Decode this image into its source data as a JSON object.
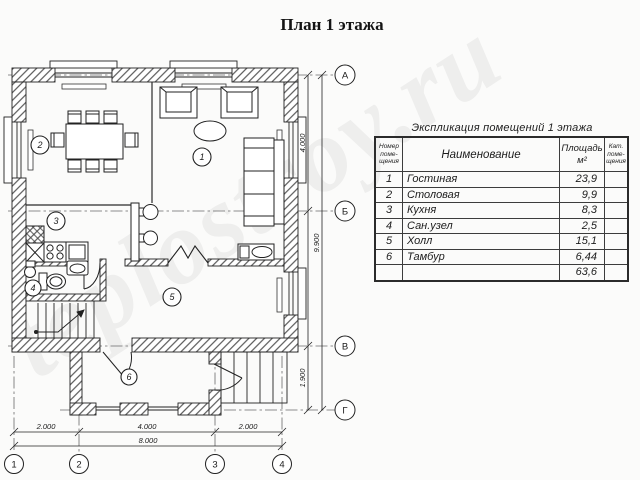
{
  "title": "План 1 этажа",
  "watermark": "teplostroy.ru",
  "explication": {
    "title": "Экспликация помещений 1 этажа",
    "headers": {
      "num": [
        "Номер",
        "поме-",
        "щения"
      ],
      "name": "Наименование",
      "area": [
        "Площадь",
        "м²"
      ],
      "cat": [
        "Кат.",
        "поме-",
        "щения"
      ]
    },
    "rows": [
      {
        "num": "1",
        "name": "Гостиная",
        "area": "23,9"
      },
      {
        "num": "2",
        "name": "Столовая",
        "area": "9,9"
      },
      {
        "num": "3",
        "name": "Кухня",
        "area": "8,3"
      },
      {
        "num": "4",
        "name": "Сан.узел",
        "area": "2,5"
      },
      {
        "num": "5",
        "name": "Холл",
        "area": "15,1"
      },
      {
        "num": "6",
        "name": "Тамбур",
        "area": "6,44"
      }
    ],
    "total_area": "63,6"
  },
  "plan": {
    "rooms": [
      "1",
      "2",
      "3",
      "4",
      "5",
      "6"
    ],
    "axes_letters": [
      "А",
      "Б",
      "В",
      "Г"
    ],
    "axes_numbers": [
      "1",
      "2",
      "3",
      "4"
    ],
    "dims_bottom": [
      "2.000",
      "4.000",
      "2.000"
    ],
    "dim_bottom_total": "8.000",
    "dim_right_top": "4.000",
    "dim_right_bottom": "1.900",
    "dim_right_total": "9.900"
  }
}
